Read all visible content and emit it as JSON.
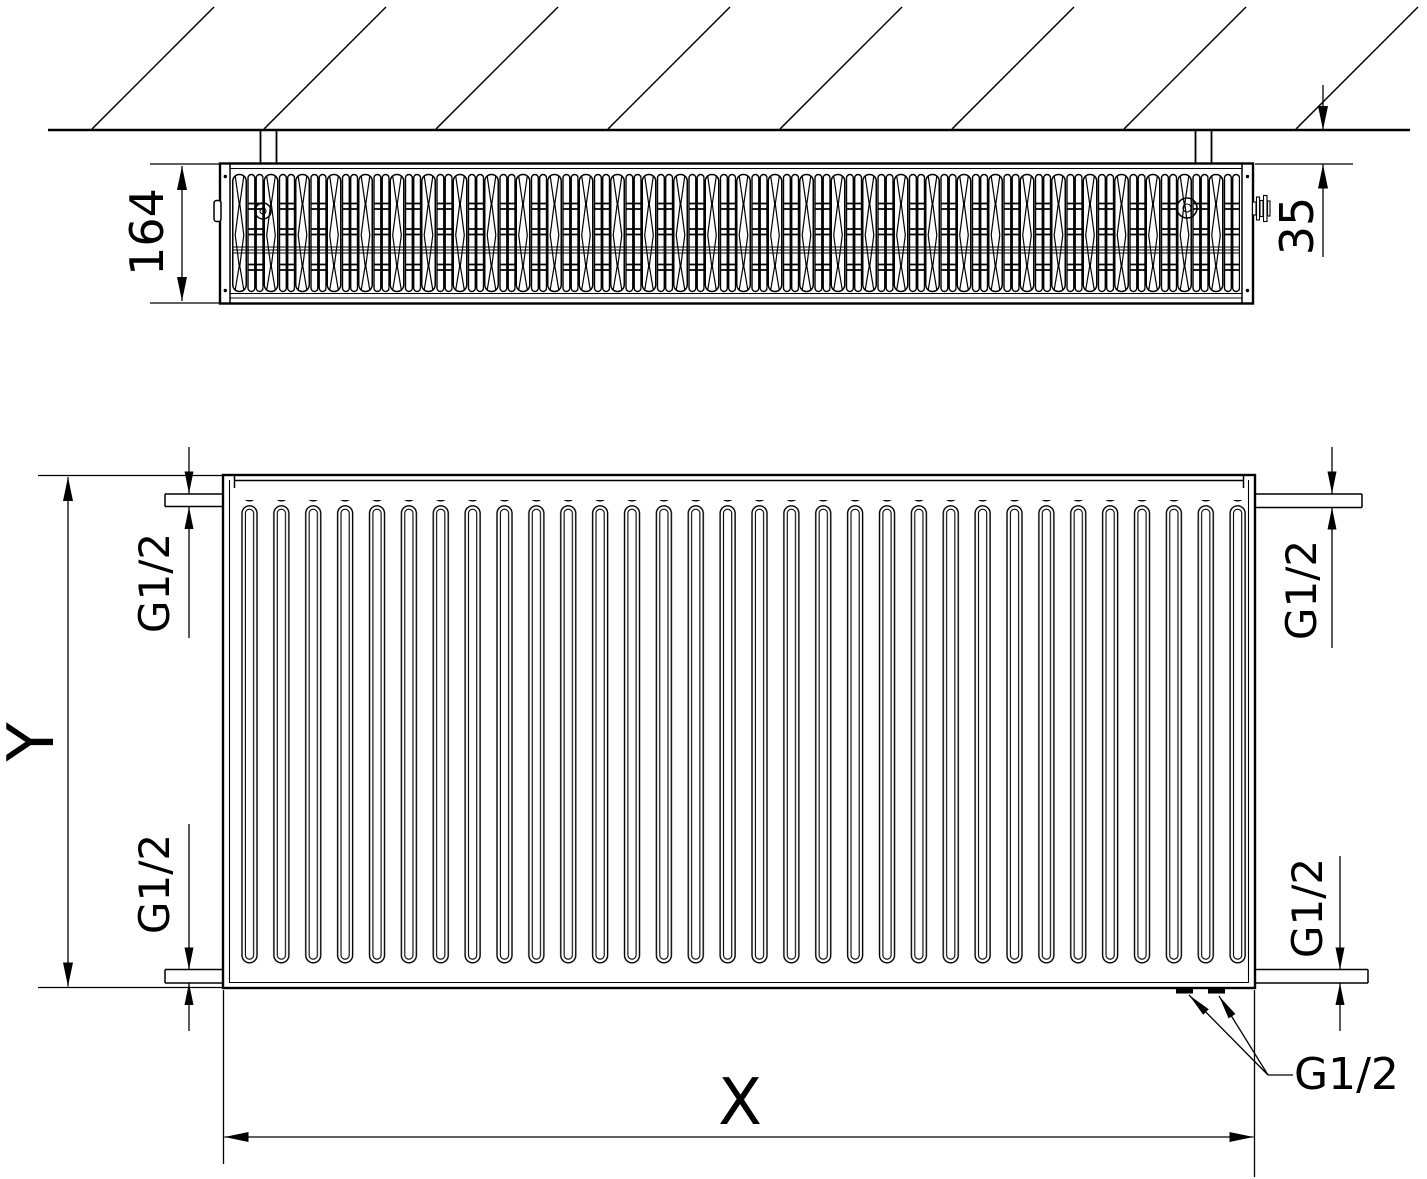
{
  "drawing": {
    "colors": {
      "ink": "#000000",
      "paper": "#ffffff"
    },
    "top_view": {
      "depth_label": "164",
      "wall_gap_label": "35"
    },
    "front_view": {
      "height_label": "Y",
      "width_label": "X",
      "thread_top_left": "G1/2",
      "thread_top_right": "G1/2",
      "thread_bottom_left": "G1/2",
      "thread_bottom_right": "G1/2",
      "bottom_outlets_label": "G1/2"
    }
  }
}
